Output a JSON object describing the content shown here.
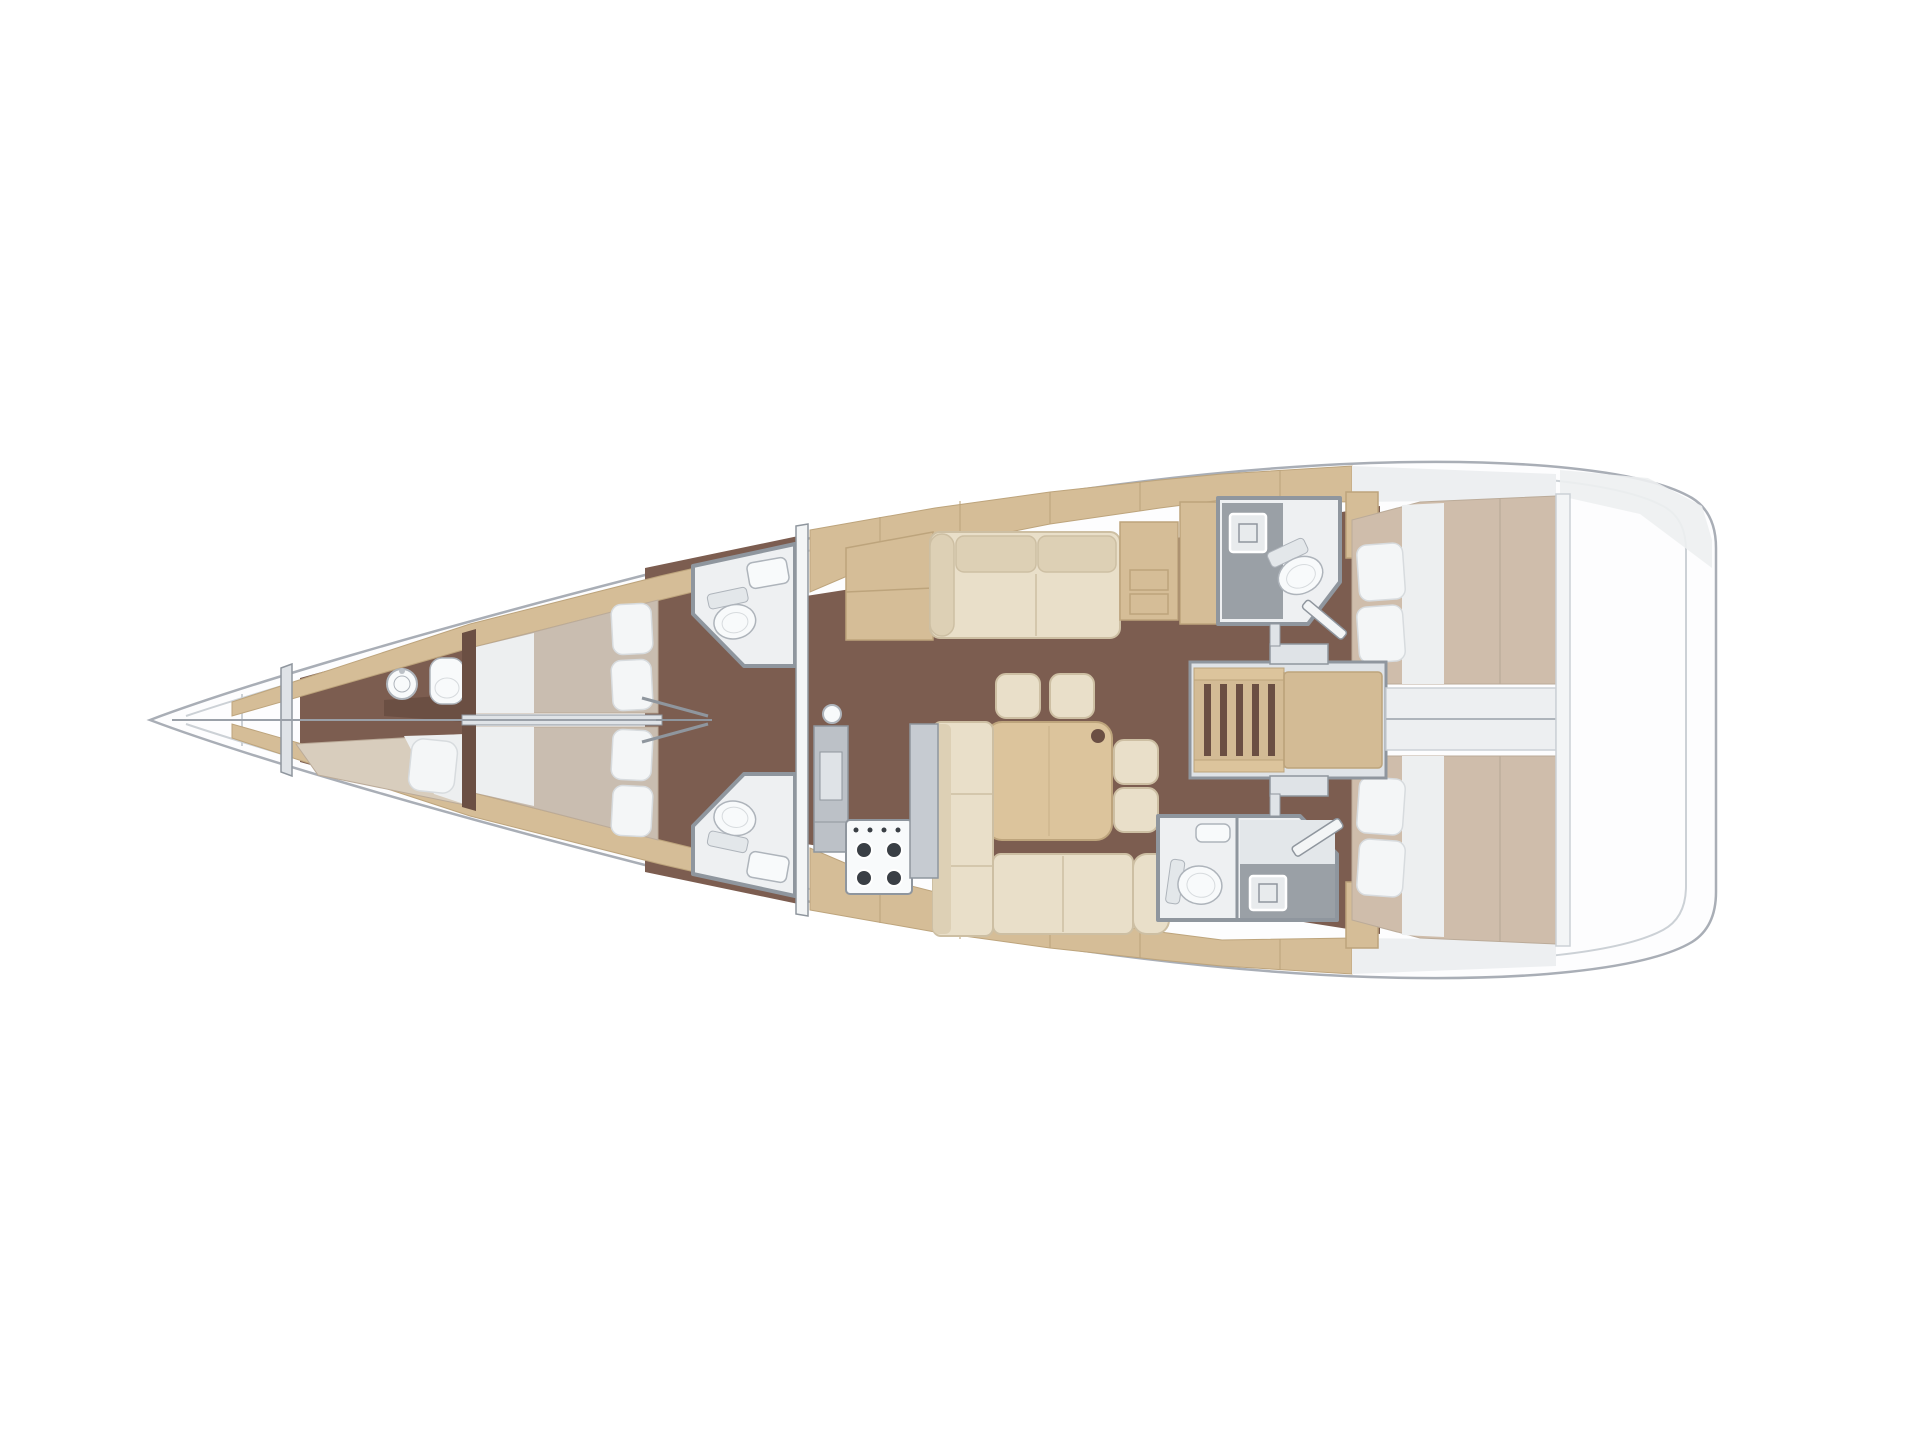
{
  "canvas": {
    "width": 1920,
    "height": 1440,
    "background": "#ffffff"
  },
  "diagram": {
    "kind": "sailing-yacht-interior-deck-plan",
    "view": "overhead",
    "bow": "left",
    "stern": "right"
  },
  "palette": {
    "deck": "#fdfdfe",
    "hullLine": "#a9aeb6",
    "innerLine": "#ccd1d6",
    "floor": "#7c5d50",
    "floorDark": "#6b4f43",
    "trim": "#d5bd97",
    "trimEdge": "#bda47c",
    "woodLight": "#dcc49c",
    "woodMid": "#d3bb95",
    "mattress": "#c9bdb0",
    "mattressAlt": "#cfbdab",
    "mattressLight": "#d8cdbd",
    "matEdge": "#bbab99",
    "sheet": "#edeff0",
    "pillow": "#f4f6f7",
    "pillowEdge": "#d7dbde",
    "cushion": "#e9dfc9",
    "cushionDark": "#ddd0b5",
    "cushionEdge": "#cdbfa3",
    "wall": "#8f969e",
    "wallFill": "#dfe3e7",
    "wallLight": "#eef0f2",
    "grayUnit": "#bcc1c7",
    "grayCounter": "#c6cbd1",
    "showerFloor": "#9aa0a6",
    "fixture": "#f8fafb",
    "fixtureEdge": "#aeb4bb",
    "tank": "#e3e7ea",
    "drain": "#e8ebed",
    "burner": "#3a3f45",
    "sternWash": "#edeff1",
    "sternWall": "#f3f5f6",
    "rig": "#9aa0a8"
  },
  "spaces": [
    {
      "id": "sail-locker",
      "fixtures": []
    },
    {
      "id": "crew-cabin",
      "fixtures": [
        "single-berth",
        "pillow",
        "round-sink",
        "toilet",
        "counter"
      ]
    },
    {
      "id": "forward-cabin-top",
      "fixtures": [
        "double-berth",
        "pillows"
      ]
    },
    {
      "id": "forward-cabin-bottom",
      "fixtures": [
        "double-berth",
        "pillows"
      ]
    },
    {
      "id": "forward-head-top",
      "fixtures": [
        "toilet",
        "sink"
      ]
    },
    {
      "id": "forward-head-bottom",
      "fixtures": [
        "toilet",
        "sink"
      ]
    },
    {
      "id": "salon",
      "fixtures": [
        "sofa",
        "side-cabinet",
        "end-table",
        "dining-table",
        "stool",
        "stool",
        "stool",
        "stool",
        "l-sofa",
        "chaise"
      ]
    },
    {
      "id": "galley",
      "fixtures": [
        "tall-cabinet",
        "stove-4-burner",
        "counter",
        "sink"
      ]
    },
    {
      "id": "aft-head-top",
      "fixtures": [
        "shower",
        "drain",
        "toilet",
        "door"
      ]
    },
    {
      "id": "aft-head-bottom",
      "fixtures": [
        "toilet",
        "sink",
        "shower",
        "drain",
        "door"
      ]
    },
    {
      "id": "companionway",
      "fixtures": [
        "ladder",
        "landing",
        "door-frame",
        "door-frame"
      ]
    },
    {
      "id": "aft-cabin-top",
      "fixtures": [
        "double-berth",
        "pillows",
        "wardrobe"
      ]
    },
    {
      "id": "aft-cabin-bottom",
      "fixtures": [
        "double-berth",
        "pillows",
        "wardrobe"
      ]
    },
    {
      "id": "stern-lazarette",
      "fixtures": []
    }
  ],
  "rigging": {
    "centerline_stay": true,
    "mast_support": true
  }
}
